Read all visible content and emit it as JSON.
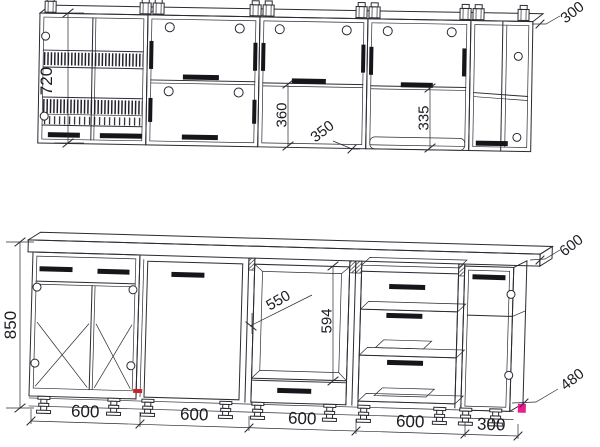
{
  "drawing": {
    "type": "kitchen-cabinet-technical-elevation",
    "rows": [
      "wall-cabinets",
      "base-cabinets"
    ]
  },
  "dimensions": {
    "wall_height": "720",
    "wall_end_width": "300",
    "wall_open_height": "360",
    "wall_gap": "350",
    "wall_lower_height": "335",
    "base_height": "850",
    "niche_width": "550",
    "niche_height": "594",
    "counter_depth": "600",
    "base_side": "480",
    "run": [
      "600",
      "600",
      "600",
      "600",
      "300"
    ]
  },
  "colors": {
    "line": "#2a2a32",
    "red_mark": "#c3242e",
    "pink_mark": "#ec1c8d"
  }
}
